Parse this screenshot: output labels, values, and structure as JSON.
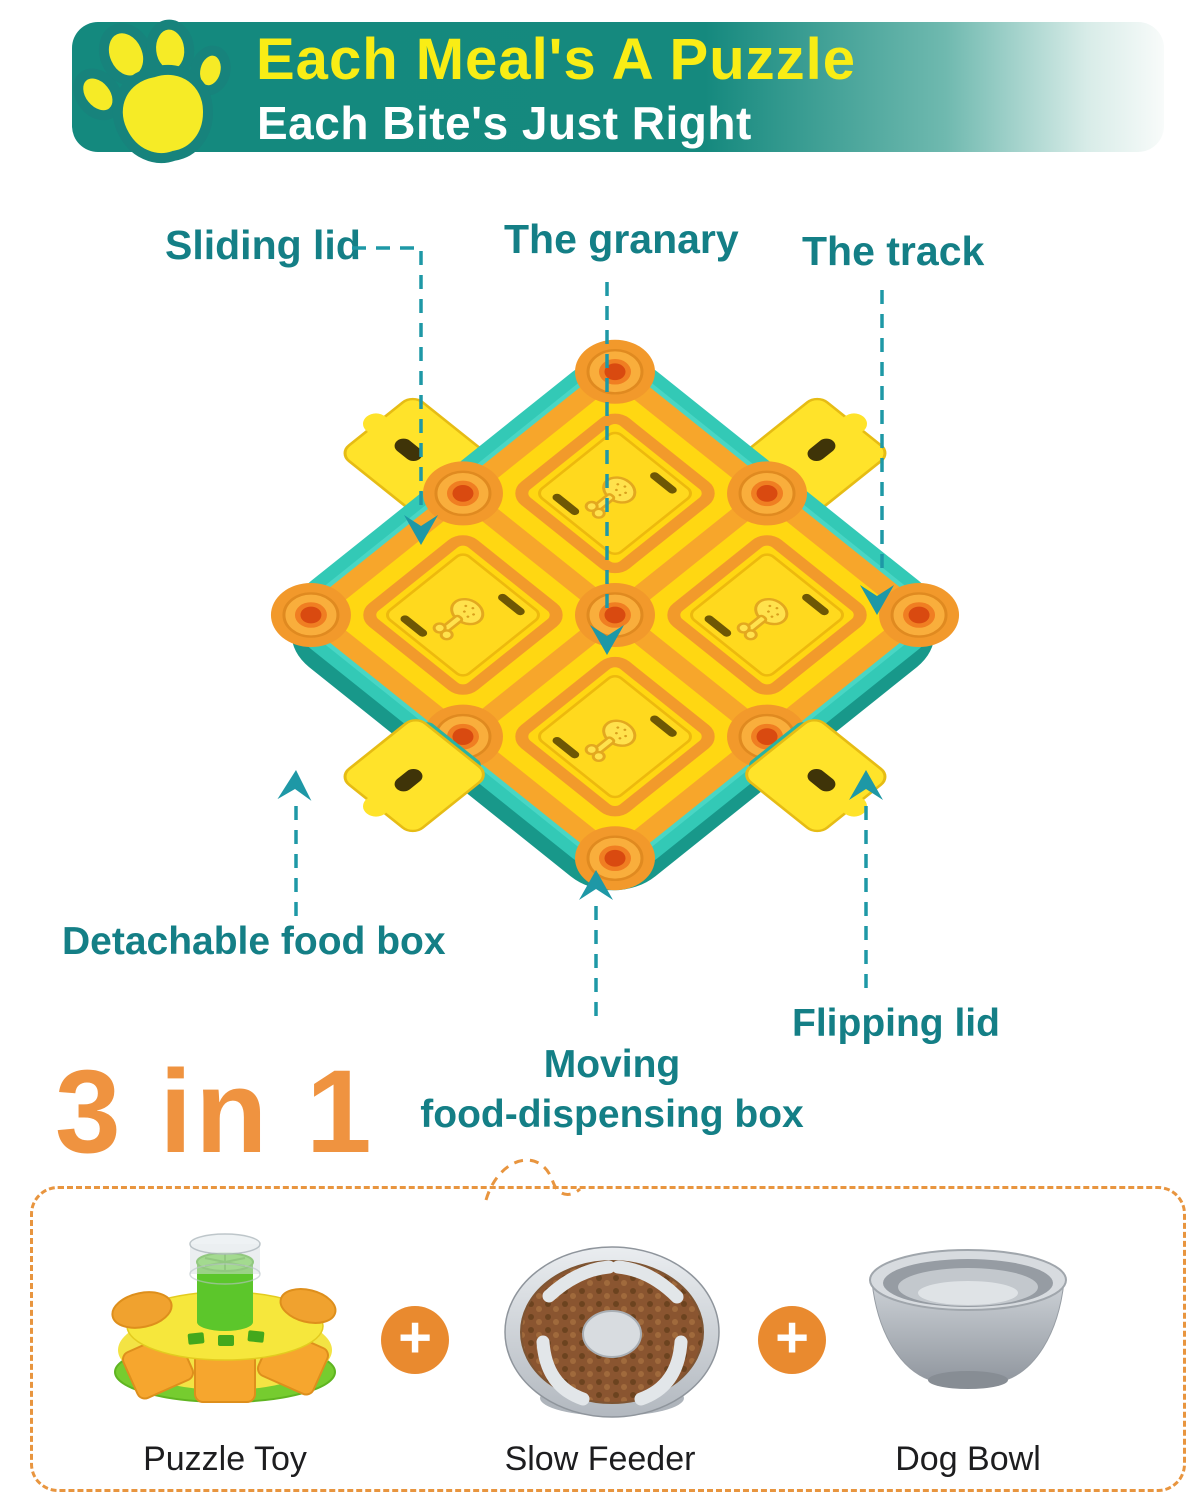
{
  "banner": {
    "title": "Each Meal's A Puzzle",
    "subtitle": "Each Bite's Just Right",
    "colors": {
      "bg": "#14897E",
      "title": "#F9ED15",
      "subtitle": "#FFFFFF",
      "paw": "#F6EB26",
      "paw_outline": "#17837C"
    }
  },
  "callouts": {
    "sliding": "Sliding lid",
    "granary": "The granary",
    "track": "The track",
    "detachable": "Detachable food box",
    "moving_line1": "Moving",
    "moving_line2": "food-dispensing box",
    "flipping": "Flipping lid",
    "text_color": "#147F86",
    "line_color": "#1E98A6"
  },
  "product": {
    "colors": {
      "tray": "#33C9B6",
      "tray_shadow": "#18988A",
      "board": "#FFD712",
      "track": "#F7A62B",
      "post": "#F9AE3C",
      "post_hole": "#D94A10",
      "lid": "#FFD91E",
      "drawer": "#FFE32A"
    }
  },
  "three_in_one": {
    "heading": "3 in 1",
    "heading_color": "#EF9340",
    "plus": "+",
    "plus_color": "#E98A2F",
    "box_border_color": "#E8953F",
    "items": [
      {
        "label": "Puzzle Toy"
      },
      {
        "label": "Slow Feeder"
      },
      {
        "label": "Dog Bowl"
      }
    ]
  }
}
